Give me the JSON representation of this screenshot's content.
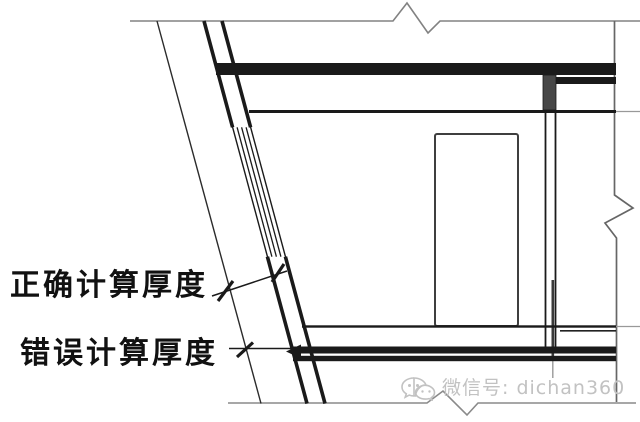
{
  "drawing": {
    "type": "architectural-section-detail",
    "callouts": {
      "correct": "正确计算厚度",
      "wrong": "错误计算厚度"
    }
  },
  "watermark": {
    "icon": "wechat-icon",
    "text": "微信号: dichan360"
  },
  "colors": {
    "line_black": "#1a1a1a",
    "line_gray": "#828282",
    "beam_fill": "#474747",
    "watermark_gray": "#c2c2c2",
    "background": "#ffffff"
  }
}
